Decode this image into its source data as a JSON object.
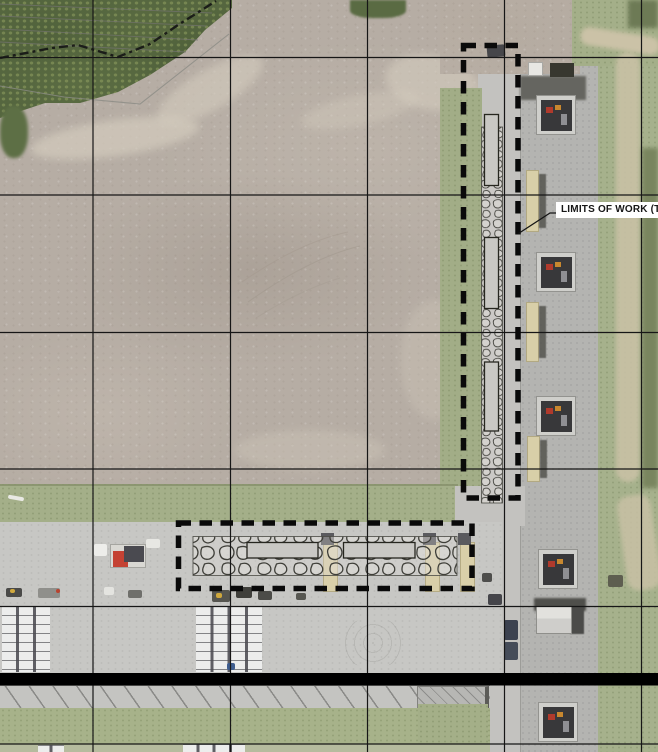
{
  "drawing": {
    "label": {
      "text": "LIMITS OF WORK (TYP",
      "x": 556,
      "y": 202,
      "w": 102,
      "h": 16
    },
    "leader_points": "560,213 550,213 518.5,233.5",
    "grid": {
      "vertical_x": [
        93,
        230.5,
        367.5,
        504.5,
        641.5
      ],
      "horizontal_y": [
        57.5,
        195,
        332.5,
        469,
        606.5,
        744
      ],
      "color": "#161616"
    },
    "limits_boxes": [
      {
        "x": 463.5,
        "y": 45.5,
        "w": 54.5,
        "h": 452.5
      },
      {
        "x": 178.5,
        "y": 523,
        "w": 293.5,
        "h": 65.5
      }
    ],
    "thick_bar": {
      "x": 0,
      "y": 673,
      "w": 658,
      "h": 12.5
    },
    "riprap": [
      {
        "x": 481.5,
        "y": 127,
        "w": 21,
        "h": 376,
        "pattern": "stonesS"
      },
      {
        "x": 193,
        "y": 536.5,
        "w": 264,
        "h": 39,
        "pattern": "stonesL"
      }
    ],
    "structures": [
      {
        "x": 484.5,
        "y": 114.5,
        "w": 14,
        "h": 71
      },
      {
        "x": 484.5,
        "y": 237.5,
        "w": 14,
        "h": 71
      },
      {
        "x": 484.5,
        "y": 362,
        "w": 14,
        "h": 69
      },
      {
        "x": 247,
        "y": 542.5,
        "w": 71,
        "h": 15.5
      },
      {
        "x": 343.5,
        "y": 542.5,
        "w": 71.5,
        "h": 15.5
      }
    ],
    "fence_points": "0,58 52,48 78,45 118,57 150,44 178,25 216,1",
    "contours": [
      [
        0,
        4,
        212,
        13
      ],
      [
        0,
        16,
        206,
        26
      ],
      [
        0,
        29,
        198,
        40
      ],
      [
        0,
        42,
        186,
        52
      ]
    ],
    "embankment_points": "0,86 64,97 140,104 229,34",
    "colors": {
      "overlay_black": "#0a0a0a",
      "stone_line": "#3f3f39",
      "grid_line": "#161616"
    }
  },
  "map_features": {
    "transformers": [
      {
        "x": 536,
        "y": 95
      },
      {
        "x": 536,
        "y": 252
      },
      {
        "x": 536,
        "y": 396
      },
      {
        "x": 538,
        "y": 549
      },
      {
        "x": 538,
        "y": 702
      }
    ],
    "service_buildings": [
      {
        "x": 526,
        "y": 170,
        "h": 62
      },
      {
        "x": 526,
        "y": 302,
        "h": 60
      },
      {
        "x": 527,
        "y": 436,
        "h": 46
      }
    ],
    "tan_posts": [
      {
        "x": 323,
        "y": 533
      },
      {
        "x": 425,
        "y": 533
      },
      {
        "x": 460,
        "y": 533
      }
    ],
    "trailer_rows": [
      {
        "x": 2,
        "y": 606,
        "w": 48,
        "h": 66,
        "cols": 3
      },
      {
        "x": 196,
        "y": 606,
        "w": 66,
        "h": 66,
        "cols": 4
      },
      {
        "x": 183,
        "y": 744,
        "w": 62,
        "h": 8,
        "cols": 4
      },
      {
        "x": 38,
        "y": 745,
        "w": 26,
        "h": 7,
        "cols": 2
      }
    ],
    "vehicles": [
      {
        "x": 487,
        "y": 45,
        "w": 18,
        "h": 12,
        "c": "#46464a",
        "r": -5
      },
      {
        "x": 504,
        "y": 620,
        "w": 14,
        "h": 20,
        "c": "#3c4250",
        "r": 0
      },
      {
        "x": 504,
        "y": 642,
        "w": 14,
        "h": 18,
        "c": "#454c59",
        "r": 0
      },
      {
        "x": 6,
        "y": 588,
        "w": 16,
        "h": 9,
        "c": "#4a4a48",
        "r": 0
      },
      {
        "x": 10,
        "y": 589,
        "w": 5,
        "h": 4,
        "c": "#d1a93e",
        "r": 0
      },
      {
        "x": 38,
        "y": 588,
        "w": 22,
        "h": 10,
        "c": "#8f8f8b",
        "r": 0
      },
      {
        "x": 56,
        "y": 589,
        "w": 4,
        "h": 4,
        "c": "#b8432f",
        "r": 0
      },
      {
        "x": 104,
        "y": 587,
        "w": 10,
        "h": 8,
        "c": "#e4e4e0",
        "r": 0
      },
      {
        "x": 128,
        "y": 590,
        "w": 14,
        "h": 8,
        "c": "#6f6f6b",
        "r": 0
      },
      {
        "x": 212,
        "y": 590,
        "w": 18,
        "h": 12,
        "c": "#55554f",
        "r": 0
      },
      {
        "x": 216,
        "y": 593,
        "w": 6,
        "h": 5,
        "c": "#cfa83c",
        "r": 0
      },
      {
        "x": 236,
        "y": 587,
        "w": 16,
        "h": 11,
        "c": "#3f3f3b",
        "r": 0
      },
      {
        "x": 258,
        "y": 591,
        "w": 14,
        "h": 9,
        "c": "#4c4c48",
        "r": 0
      },
      {
        "x": 296,
        "y": 593,
        "w": 10,
        "h": 7,
        "c": "#575751",
        "r": 0
      },
      {
        "x": 227,
        "y": 663,
        "w": 8,
        "h": 7,
        "c": "#3e5d8f",
        "r": 0
      },
      {
        "x": 608,
        "y": 575,
        "w": 15,
        "h": 12,
        "c": "#5e5e50",
        "r": 0
      },
      {
        "x": 8,
        "y": 496,
        "w": 16,
        "h": 4,
        "c": "#e9e9e4",
        "r": 10
      },
      {
        "x": 146,
        "y": 539,
        "w": 14,
        "h": 9,
        "c": "#e7e7e3",
        "r": 0
      },
      {
        "x": 94,
        "y": 544,
        "w": 13,
        "h": 12,
        "c": "#ededea",
        "r": 0
      },
      {
        "x": 482,
        "y": 573,
        "w": 10,
        "h": 9,
        "c": "#4e4e4c",
        "r": 0
      },
      {
        "x": 488,
        "y": 594,
        "w": 14,
        "h": 11,
        "c": "#45454a",
        "r": 0
      }
    ],
    "red_truck": {
      "x": 110,
      "y": 544,
      "w": 36,
      "h": 24
    },
    "white_shed": {
      "x": 528,
      "y": 62,
      "w": 15,
      "h": 14
    },
    "bins": {
      "x": 550,
      "y": 63,
      "w": 24,
      "h": 14
    },
    "gable_building": {
      "x": 536,
      "y": 606,
      "w": 36,
      "h": 28
    }
  }
}
